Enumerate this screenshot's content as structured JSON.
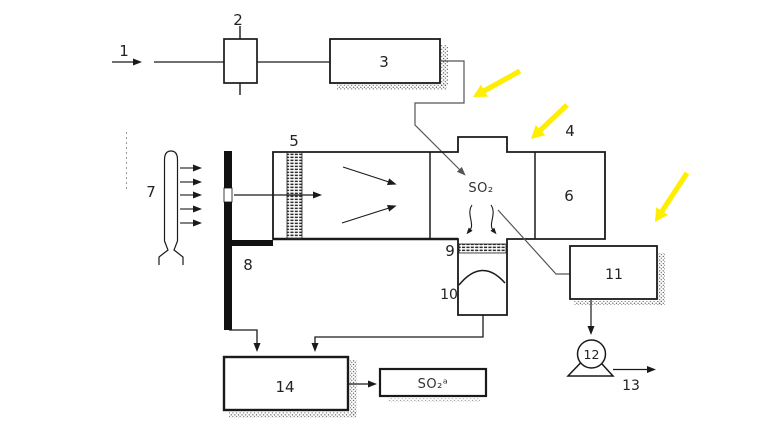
{
  "diagram": {
    "labels": {
      "n1": "1",
      "n2": "2",
      "n3": "3",
      "n4": "4",
      "n5": "5",
      "n6": "6",
      "n7": "7",
      "n8": "8",
      "n9": "9",
      "n10": "10",
      "n11": "11",
      "n12": "12",
      "n13": "13",
      "n14": "14"
    },
    "chem": {
      "so2": "SO₂",
      "so2_a": "SO₂ᵃ"
    },
    "colors": {
      "highlight": "#ffee00",
      "line": "#1a1a1a",
      "gray_line": "#555555",
      "background": "#ffffff"
    }
  }
}
